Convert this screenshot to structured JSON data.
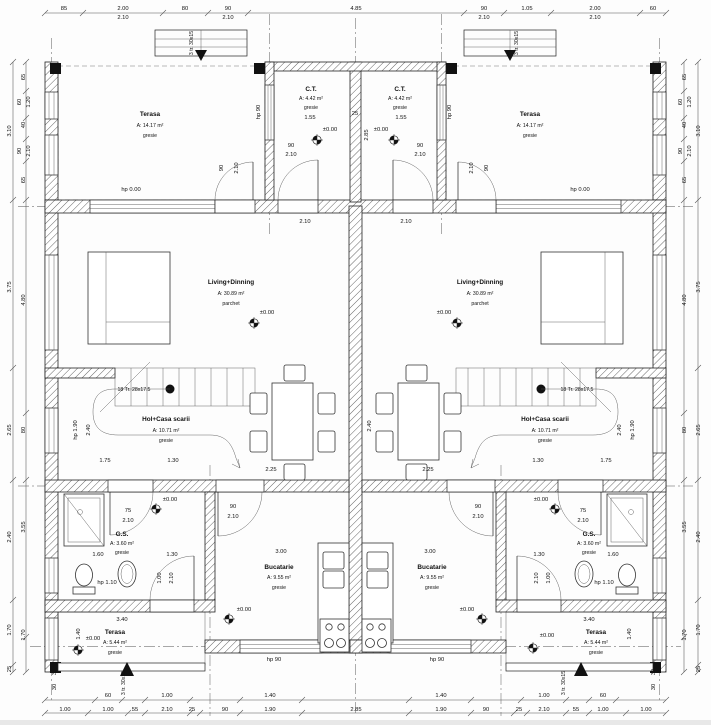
{
  "rooms": {
    "terasa_top": {
      "name": "Terasa",
      "area": "A: 14.17 m²",
      "floor": "gresie"
    },
    "ct": {
      "name": "C.T.",
      "area": "A: 4.42 m²",
      "floor": "gresie"
    },
    "living": {
      "name": "Living+Dinning",
      "area": "A: 30.89 m²",
      "floor": "parchet"
    },
    "hol": {
      "name": "Hol+Casa scarii",
      "area": "A: 10.71 m²",
      "floor": "gresie"
    },
    "gs": {
      "name": "G.S.",
      "area": "A: 3.60 m²",
      "floor": "gresie"
    },
    "bucatarie": {
      "name": "Bucatarie",
      "area": "A: 9.55 m²",
      "floor": "gresie"
    },
    "terasa_bottom": {
      "name": "Terasa",
      "area": "A: 5.44 m²",
      "floor": "gresie"
    }
  },
  "annotations": {
    "level_zero": "±0.00",
    "hp_000": "hp 0.00",
    "hp_90": "hp 90",
    "hp_110": "hp 1.10",
    "hp_190": "hp 1.90",
    "stairs_main": "18 Tr. 28x17.5",
    "stairs_ext": "3 tr. 30x15"
  },
  "dims": {
    "top": [
      "85",
      "2.00",
      "2.10",
      "80",
      "90",
      "2.10",
      "4.85",
      "90",
      "2.10",
      "1.05",
      "2.00",
      "2.10",
      "60"
    ],
    "side": [
      "3.10",
      "3.75",
      "2.65",
      "2.40",
      "1.70",
      "25",
      "65",
      "60",
      "1.20",
      "40",
      "90",
      "2.10",
      "65",
      "4.80",
      "80",
      "3.55",
      "1.70",
      "30"
    ],
    "bottom_r1": [
      "60",
      "1.00",
      "1.40",
      "1.40",
      "1.00",
      "60"
    ],
    "bottom_r2": [
      "1.00",
      "1.00",
      "55",
      "2.10",
      "25",
      "90",
      "1.90",
      "2.85",
      "1.90",
      "90",
      "25",
      "2.10",
      "55",
      "1.00",
      "1.00"
    ],
    "i": {
      "d90": "90",
      "d210": "2.10",
      "d75": "75",
      "d155": "1.55",
      "d25": "25",
      "d285": "2.85",
      "d240": "2.40",
      "d225": "2.25",
      "d175": "1.75",
      "d130": "1.30",
      "d160": "1.60",
      "d100": "1.00",
      "d300": "3.00",
      "d340": "3.40",
      "d140": "1.40"
    }
  }
}
